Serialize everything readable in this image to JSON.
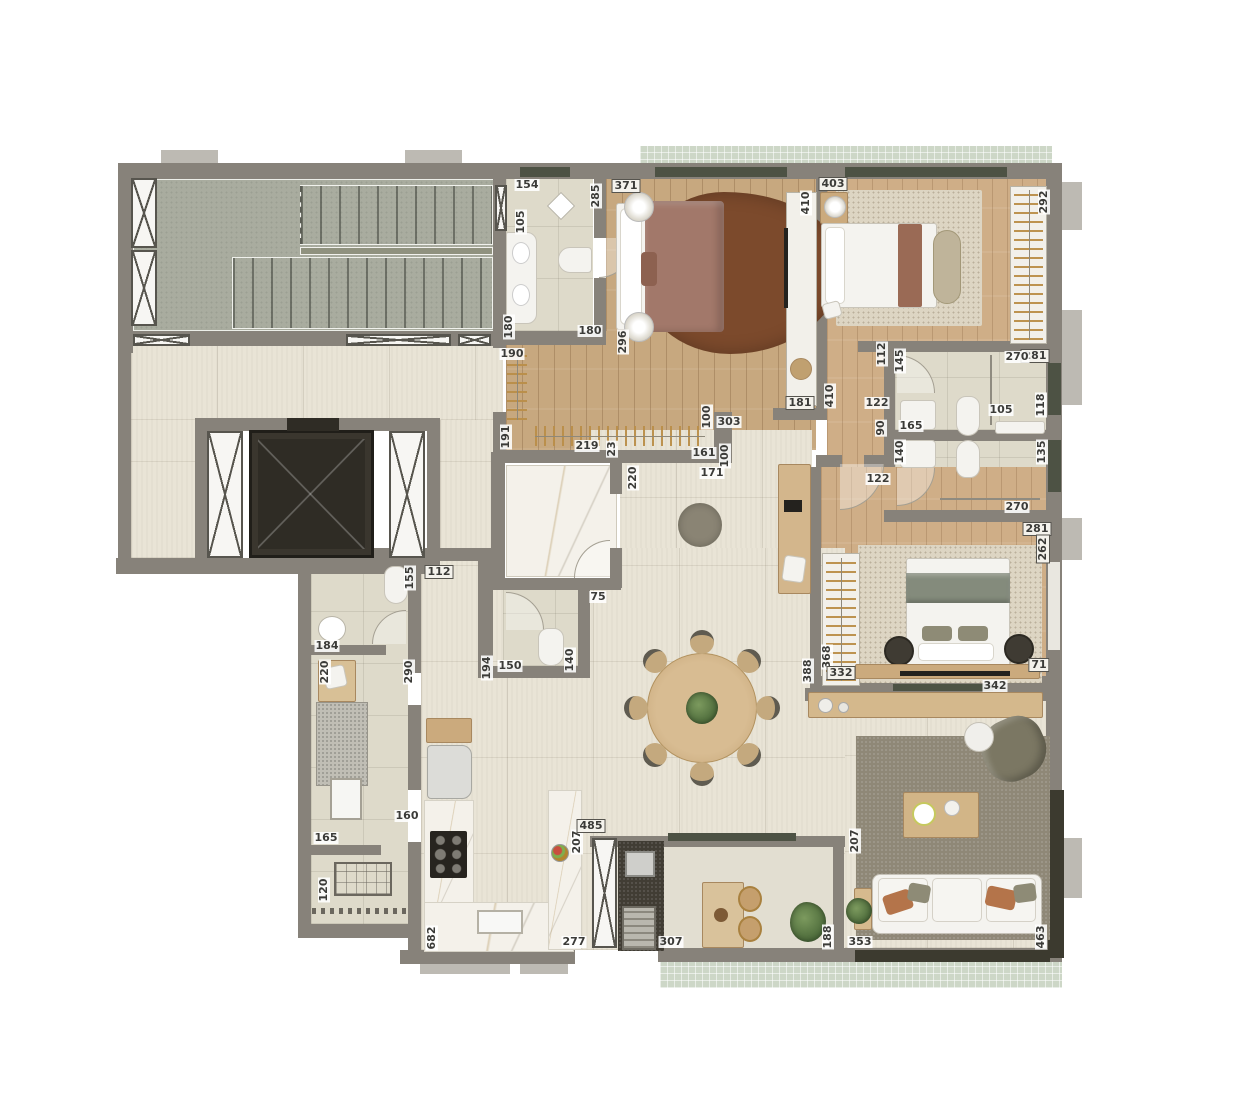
{
  "palette": {
    "wall": "#87827a",
    "wall_light": "#bdbab3",
    "floor_tile": "#e9e4d6",
    "floor_bath": "#dedaca",
    "floor_wood": "#c7a87f",
    "floor_wood2": "#cfae87",
    "floor_stair": "#a9ac9f",
    "floor_marble": "#f4f1ea",
    "floor_mint": "#cdd7c7",
    "counter_dark": "#413d34",
    "rug_brown": "#7c4a2c",
    "rug_cream": "#ddd5c3",
    "rug_taupe": "#8f8877",
    "furn_white": "#f4f3ef",
    "furn_wood": "#cbaa7d",
    "sill": "#4d5244",
    "label_text": "#3b3b38"
  },
  "labels": [
    {
      "t": "154",
      "x": 527,
      "y": 185,
      "r": 0,
      "b": 0
    },
    {
      "t": "285",
      "x": 596,
      "y": 196,
      "r": 1,
      "b": 0
    },
    {
      "t": "105",
      "x": 521,
      "y": 222,
      "r": 1,
      "b": 0
    },
    {
      "t": "180",
      "x": 509,
      "y": 327,
      "r": 1,
      "b": 0
    },
    {
      "t": "180",
      "x": 590,
      "y": 331,
      "r": 0,
      "b": 0
    },
    {
      "t": "371",
      "x": 626,
      "y": 186,
      "r": 0,
      "b": 1
    },
    {
      "t": "296",
      "x": 623,
      "y": 342,
      "r": 1,
      "b": 0
    },
    {
      "t": "410",
      "x": 806,
      "y": 203,
      "r": 1,
      "b": 0
    },
    {
      "t": "181",
      "x": 800,
      "y": 403,
      "r": 0,
      "b": 1
    },
    {
      "t": "190",
      "x": 512,
      "y": 354,
      "r": 0,
      "b": 0
    },
    {
      "t": "191",
      "x": 506,
      "y": 437,
      "r": 1,
      "b": 0
    },
    {
      "t": "219",
      "x": 587,
      "y": 446,
      "r": 0,
      "b": 0
    },
    {
      "t": "23",
      "x": 612,
      "y": 449,
      "r": 1,
      "b": 0
    },
    {
      "t": "161",
      "x": 704,
      "y": 453,
      "r": 0,
      "b": 0
    },
    {
      "t": "100",
      "x": 707,
      "y": 417,
      "r": 1,
      "b": 0
    },
    {
      "t": "303",
      "x": 729,
      "y": 422,
      "r": 0,
      "b": 0
    },
    {
      "t": "100",
      "x": 725,
      "y": 456,
      "r": 1,
      "b": 0
    },
    {
      "t": "220",
      "x": 633,
      "y": 478,
      "r": 1,
      "b": 0
    },
    {
      "t": "171",
      "x": 712,
      "y": 473,
      "r": 0,
      "b": 0
    },
    {
      "t": "75",
      "x": 598,
      "y": 597,
      "r": 0,
      "b": 0
    },
    {
      "t": "150",
      "x": 510,
      "y": 666,
      "r": 0,
      "b": 0
    },
    {
      "t": "140",
      "x": 570,
      "y": 660,
      "r": 1,
      "b": 0
    },
    {
      "t": "194",
      "x": 487,
      "y": 668,
      "r": 1,
      "b": 0
    },
    {
      "t": "155",
      "x": 410,
      "y": 578,
      "r": 1,
      "b": 0
    },
    {
      "t": "184",
      "x": 327,
      "y": 646,
      "r": 0,
      "b": 0
    },
    {
      "t": "112",
      "x": 439,
      "y": 572,
      "r": 0,
      "b": 1
    },
    {
      "t": "220",
      "x": 325,
      "y": 672,
      "r": 1,
      "b": 0
    },
    {
      "t": "290",
      "x": 409,
      "y": 672,
      "r": 1,
      "b": 0
    },
    {
      "t": "160",
      "x": 407,
      "y": 816,
      "r": 0,
      "b": 0
    },
    {
      "t": "165",
      "x": 326,
      "y": 838,
      "r": 0,
      "b": 0
    },
    {
      "t": "120",
      "x": 324,
      "y": 890,
      "r": 1,
      "b": 0
    },
    {
      "t": "682",
      "x": 432,
      "y": 938,
      "r": 1,
      "b": 0
    },
    {
      "t": "277",
      "x": 574,
      "y": 942,
      "r": 0,
      "b": 0
    },
    {
      "t": "207",
      "x": 577,
      "y": 842,
      "r": 1,
      "b": 0
    },
    {
      "t": "485",
      "x": 591,
      "y": 826,
      "r": 0,
      "b": 1
    },
    {
      "t": "307",
      "x": 671,
      "y": 942,
      "r": 0,
      "b": 0
    },
    {
      "t": "188",
      "x": 828,
      "y": 937,
      "r": 1,
      "b": 0
    },
    {
      "t": "207",
      "x": 855,
      "y": 841,
      "r": 1,
      "b": 0
    },
    {
      "t": "353",
      "x": 860,
      "y": 942,
      "r": 0,
      "b": 0
    },
    {
      "t": "463",
      "x": 1041,
      "y": 937,
      "r": 1,
      "b": 0
    },
    {
      "t": "342",
      "x": 995,
      "y": 686,
      "r": 0,
      "b": 0
    },
    {
      "t": "368",
      "x": 827,
      "y": 657,
      "r": 1,
      "b": 0
    },
    {
      "t": "332",
      "x": 841,
      "y": 673,
      "r": 0,
      "b": 1
    },
    {
      "t": "388",
      "x": 808,
      "y": 671,
      "r": 1,
      "b": 0
    },
    {
      "t": "71",
      "x": 1039,
      "y": 665,
      "r": 0,
      "b": 1
    },
    {
      "t": "281",
      "x": 1037,
      "y": 529,
      "r": 0,
      "b": 1
    },
    {
      "t": "262",
      "x": 1043,
      "y": 549,
      "r": 1,
      "b": 1
    },
    {
      "t": "122",
      "x": 878,
      "y": 479,
      "r": 0,
      "b": 0
    },
    {
      "t": "403",
      "x": 833,
      "y": 184,
      "r": 0,
      "b": 1
    },
    {
      "t": "410",
      "x": 830,
      "y": 396,
      "r": 1,
      "b": 0
    },
    {
      "t": "292",
      "x": 1044,
      "y": 202,
      "r": 1,
      "b": 0
    },
    {
      "t": "281",
      "x": 1035,
      "y": 356,
      "r": 0,
      "b": 1
    },
    {
      "t": "112",
      "x": 882,
      "y": 354,
      "r": 1,
      "b": 0
    },
    {
      "t": "90",
      "x": 881,
      "y": 428,
      "r": 1,
      "b": 0
    },
    {
      "t": "122",
      "x": 877,
      "y": 403,
      "r": 0,
      "b": 0
    },
    {
      "t": "145",
      "x": 900,
      "y": 361,
      "r": 1,
      "b": 0
    },
    {
      "t": "270",
      "x": 1017,
      "y": 357,
      "r": 0,
      "b": 0
    },
    {
      "t": "118",
      "x": 1041,
      "y": 405,
      "r": 1,
      "b": 0
    },
    {
      "t": "105",
      "x": 1001,
      "y": 410,
      "r": 0,
      "b": 0
    },
    {
      "t": "165",
      "x": 911,
      "y": 426,
      "r": 0,
      "b": 0
    },
    {
      "t": "140",
      "x": 900,
      "y": 452,
      "r": 1,
      "b": 0
    },
    {
      "t": "135",
      "x": 1042,
      "y": 452,
      "r": 1,
      "b": 0
    },
    {
      "t": "270",
      "x": 1017,
      "y": 507,
      "r": 0,
      "b": 0
    }
  ]
}
